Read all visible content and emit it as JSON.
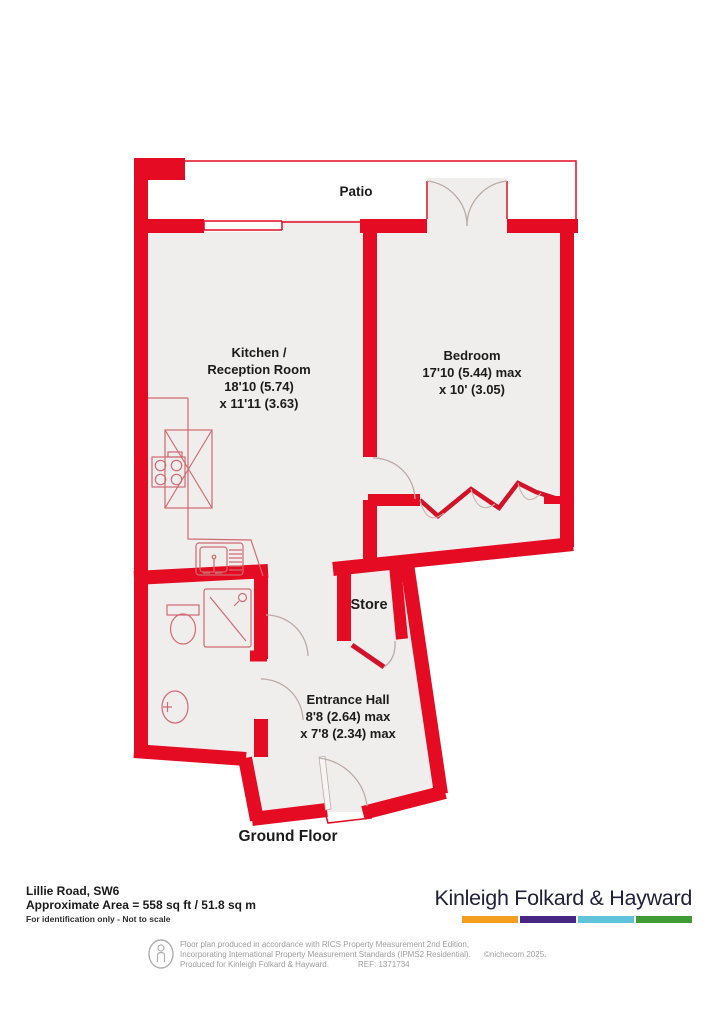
{
  "plan": {
    "patio": "Patio",
    "kitchen": {
      "line1": "Kitchen /",
      "line2": "Reception Room",
      "line3": "18'10 (5.74)",
      "line4": "x 11'11 (3.63)"
    },
    "bedroom": {
      "line1": "Bedroom",
      "line2": "17'10 (5.44) max",
      "line3": "x 10' (3.05)"
    },
    "store": {
      "line1": "Store"
    },
    "entrance_hall": {
      "line1": "Entrance Hall",
      "line2": "8'8 (2.64) max",
      "line3": "x 7'8 (2.34) max"
    },
    "floor_label": "Ground Floor"
  },
  "footer": {
    "address": "Lillie Road, SW6",
    "area_line": "Approximate Area = 558 sq ft / 51.8 sq m",
    "identification_note": "For identification only - Not to scale",
    "brand_name": "Kinleigh Folkard & Hayward",
    "brand_bar_colors": [
      "#f4a01e",
      "#482683",
      "#5fc4d8",
      "#3f9c35"
    ],
    "disclaimer_line1": "Floor plan produced in accordance with RICS Property Measurement 2nd Edition,",
    "disclaimer_line2": "Incorporating International Property Measurement Standards (IPMS2 Residential).",
    "disclaimer_copyright": "©nichecom 2025.",
    "disclaimer_line3": "Produced for Kinleigh Folkard & Hayward.",
    "disclaimer_ref": "REF: 1371734"
  },
  "colors": {
    "wall": "#e40b22",
    "floor": "#f0eeed"
  }
}
